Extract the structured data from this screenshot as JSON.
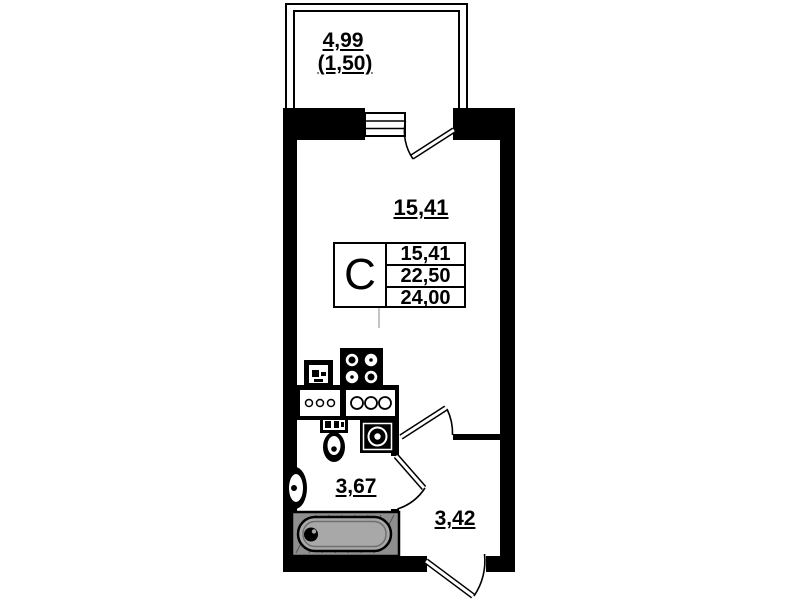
{
  "plan": {
    "balcony": {
      "area_label": "4,99",
      "area_coef_label": "(1,50)"
    },
    "living_room": {
      "area_label": "15,41"
    },
    "bathroom": {
      "area_label": "3,67"
    },
    "hallway": {
      "area_label": "3,42"
    }
  },
  "stamp": {
    "unit_type": "C",
    "areas": {
      "living": "15,41",
      "apartment": "22,50",
      "total": "24,00"
    }
  },
  "colors": {
    "wall": "#000000",
    "background": "#ffffff",
    "tub_frame": "#8f8f8f",
    "tub_fill": "#a8a8a8"
  }
}
